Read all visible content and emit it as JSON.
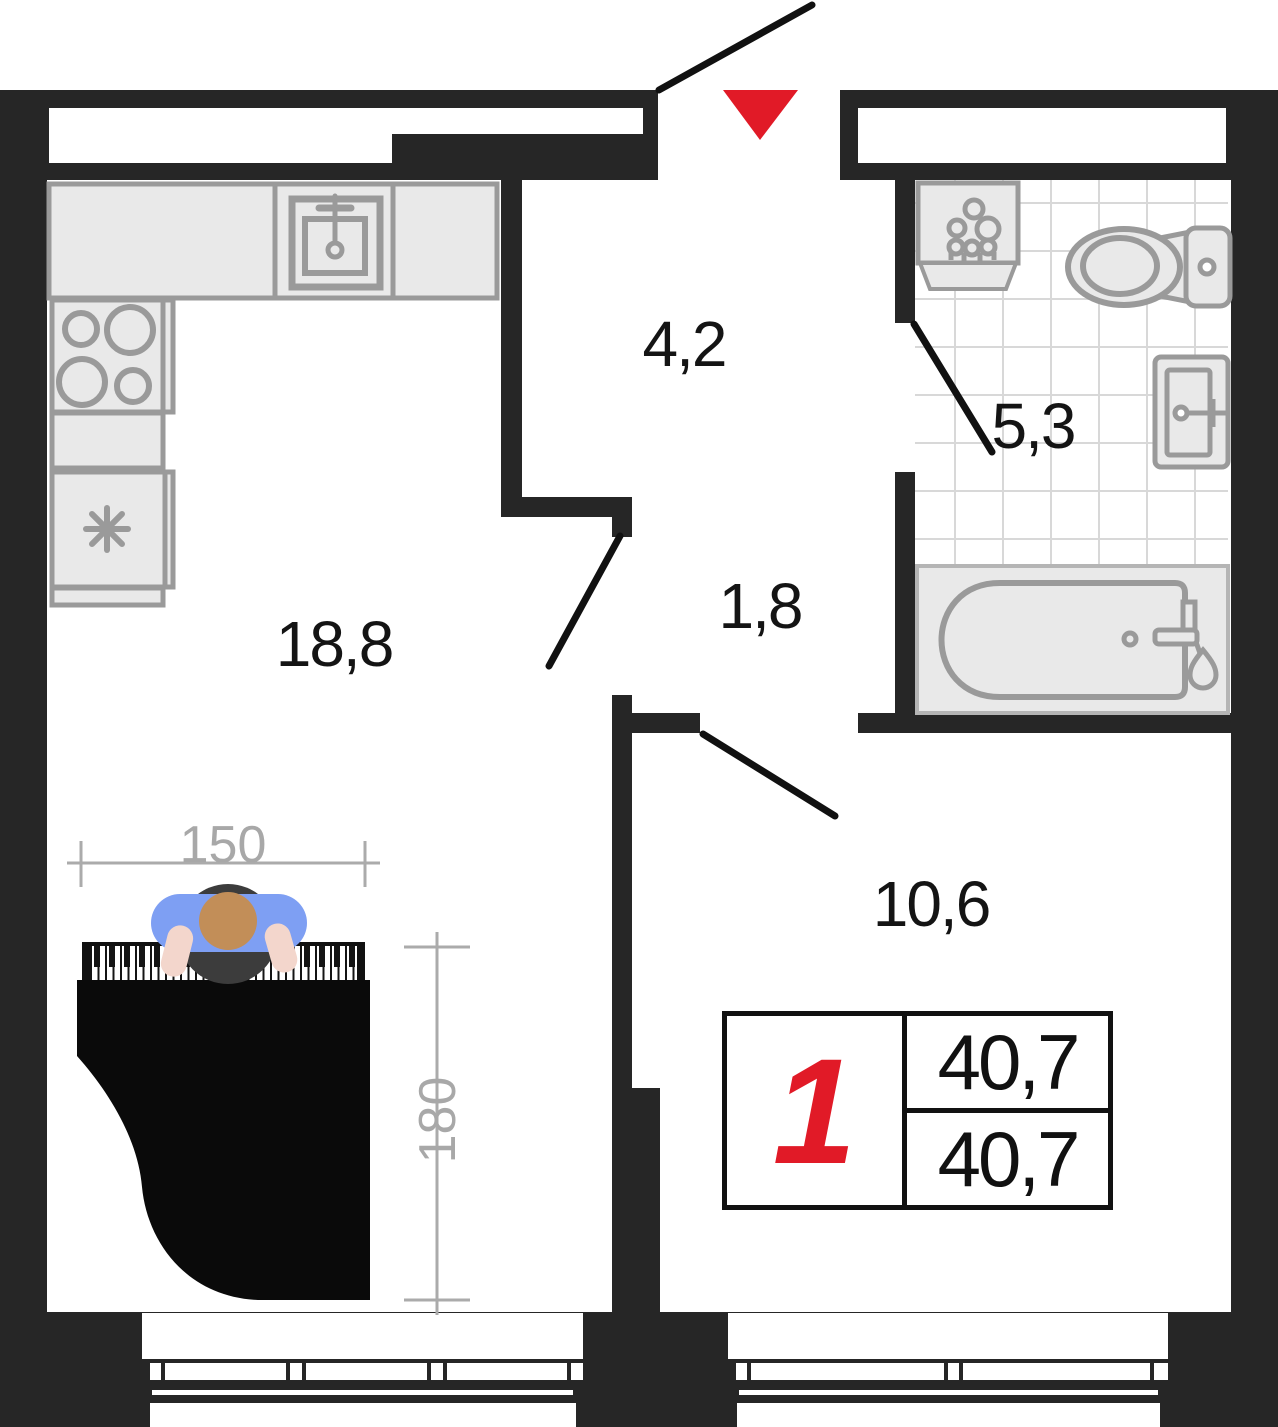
{
  "plan": {
    "rooms": [
      {
        "id": "kitchen-living",
        "area": "18,8"
      },
      {
        "id": "hallway",
        "area": "4,2"
      },
      {
        "id": "bathroom",
        "area": "5,3"
      },
      {
        "id": "corridor",
        "area": "1,8"
      },
      {
        "id": "bedroom",
        "area": "10,6"
      }
    ],
    "piano_dimensions": {
      "width_cm": "150",
      "depth_cm": "180"
    },
    "summary": {
      "rooms_count": "1",
      "area_total": "40,7",
      "area_living": "40,7"
    },
    "colors": {
      "wall": "#262626",
      "accent_red": "#e11a27",
      "fixture_stroke": "#9a9a9a",
      "fixture_fill": "#e9e9e9",
      "dimension_gray": "#a8a8a8"
    },
    "icons": [
      "entrance-arrow-icon",
      "door-swing",
      "kitchen-sink-icon",
      "stove-icon",
      "fridge-icon",
      "washing-machine-icon",
      "toilet-icon",
      "bathroom-sink-icon",
      "bathtub-icon",
      "grand-piano-icon",
      "person-icon",
      "window"
    ]
  }
}
